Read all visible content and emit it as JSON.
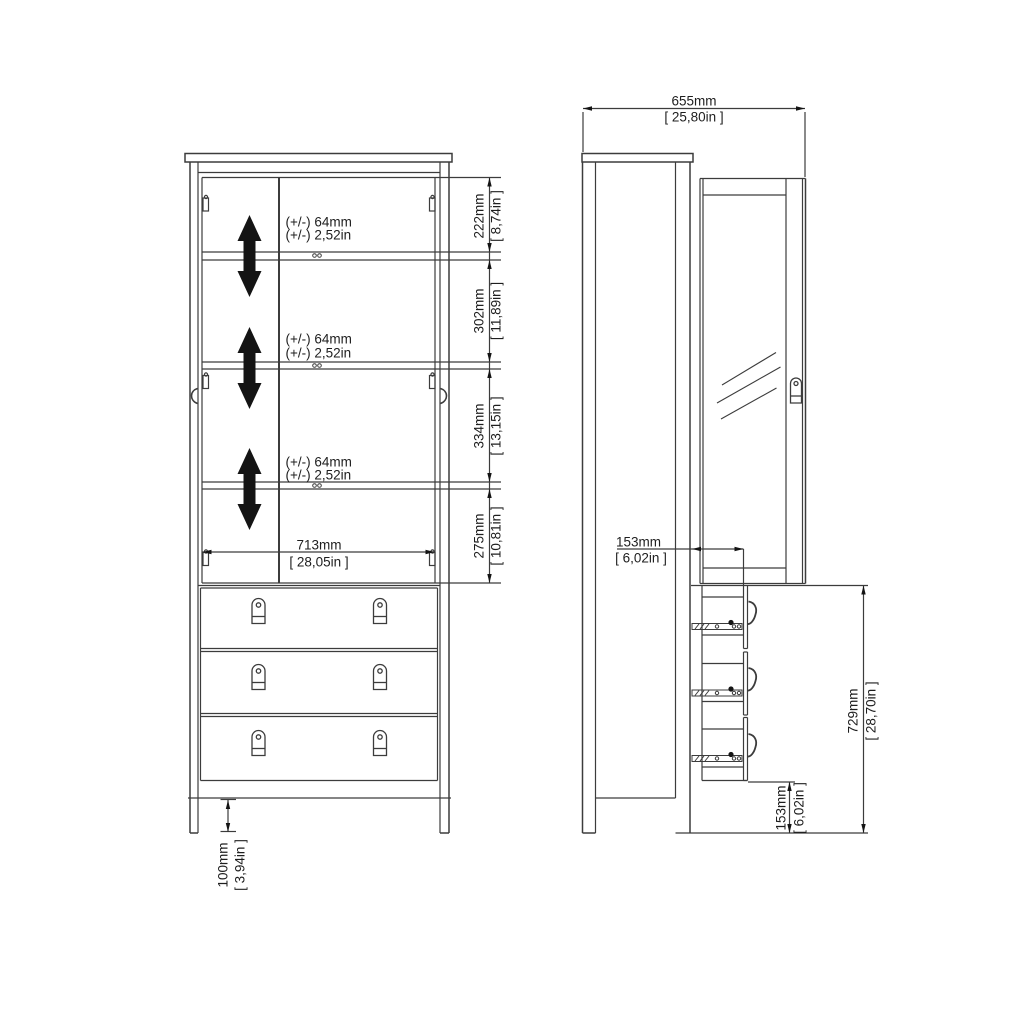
{
  "drawing_title": "cabinet-technical-drawing",
  "colors": {
    "background": "#ffffff",
    "line": "#3c3c3c",
    "text": "#1e1e1e",
    "arrow": "#141414"
  },
  "front_view": {
    "name": "front-elevation",
    "shelf_adjust": {
      "mm": "(+/-) 64mm",
      "in": "(+/-) 2,52in"
    },
    "dims": {
      "height_top": {
        "mm": "222mm",
        "in": "[ 8,74in ]"
      },
      "height_mid1": {
        "mm": "302mm",
        "in": "[ 11,89in ]"
      },
      "height_mid2": {
        "mm": "334mm",
        "in": "[ 13,15in ]"
      },
      "height_bottom": {
        "mm": "275mm",
        "in": "[ 10,81in ]"
      },
      "inner_width": {
        "mm": "713mm",
        "in": "[ 28,05in ]"
      },
      "leg_height": {
        "mm": "100mm",
        "in": "[ 3,94in ]"
      }
    }
  },
  "side_view": {
    "name": "side-elevation",
    "dims": {
      "depth": {
        "mm": "655mm",
        "in": "[ 25,80in ]"
      },
      "drawer_offset": {
        "mm": "153mm",
        "in": "[ 6,02in ]"
      },
      "drawer_section_height": {
        "mm": "729mm",
        "in": "[ 28,70in ]"
      },
      "base_clearance": {
        "mm": "153mm",
        "in": "[ 6,02in ]"
      }
    }
  }
}
